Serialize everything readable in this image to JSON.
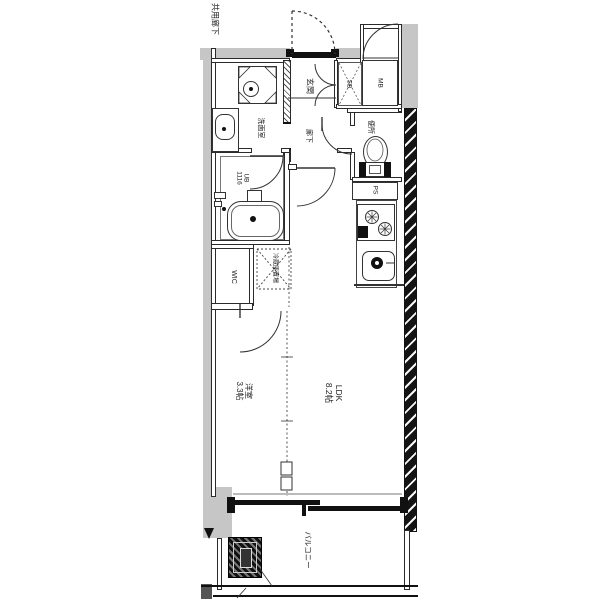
{
  "plan": {
    "common_corridor": "共用廊下",
    "entrance": "玄関",
    "shoe_box": "SB",
    "meter_box": "MB",
    "hallway": "廊下",
    "toilet": "便所",
    "washroom": "洗面室",
    "unit_bath": "UB",
    "unit_bath_size": "1116",
    "wic": "WIC",
    "refrigerator_space": "冷蔵庫置場",
    "pipe_space": "PS",
    "ldk": "LDK",
    "ldk_size": "8.2帖",
    "western_room": "洋室",
    "western_room_size": "3.3帖",
    "balcony": "バルコニー"
  },
  "colors": {
    "wall_dark": "#111111",
    "gray_fill": "#c6c6c6",
    "line": "#333333"
  }
}
